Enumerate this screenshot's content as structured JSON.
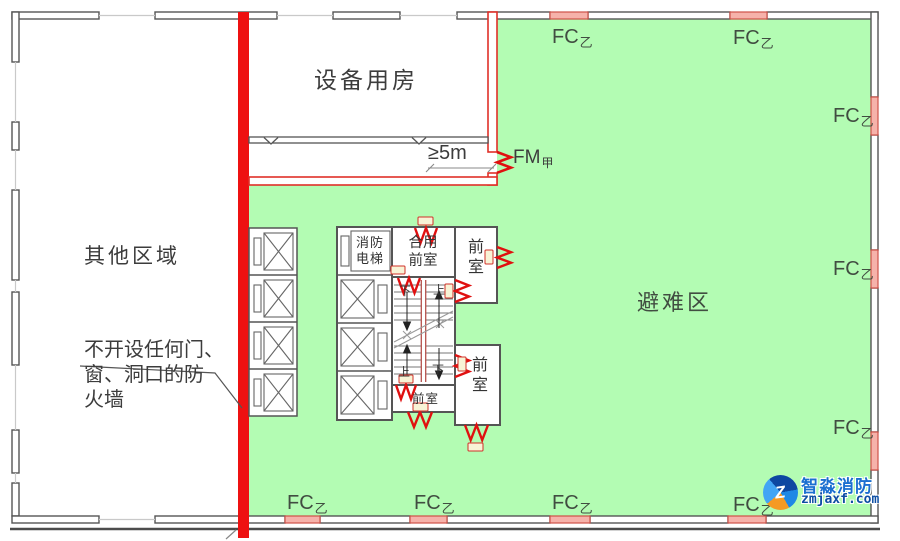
{
  "labels": {
    "equipment_room": "设备用房",
    "other_area": "其他区域",
    "refuge_area": "避难区",
    "firewall_note": "不开设任何门、\n窗、洞口的防\n火墙",
    "distance": "≥5m",
    "fire_door": {
      "main": "FM",
      "sub": "甲"
    },
    "fire_window": {
      "main": "FC",
      "sub": "乙"
    }
  },
  "core": {
    "fire_elevator": "消防电梯",
    "shared_vestibule": "合用前室",
    "vestibule": "前室",
    "up": "上",
    "down": "下"
  },
  "watermark": {
    "brand": "智淼消防",
    "site": "zmjaxf.com",
    "monogram": "Z"
  },
  "colors": {
    "refuge_fill": "#b3fcb3",
    "firewall_red": "#ee1111",
    "door_red": "#e01010",
    "window_pink": "#f6b2aa",
    "window_border": "#cf5148",
    "wall_gray": "#555555"
  }
}
